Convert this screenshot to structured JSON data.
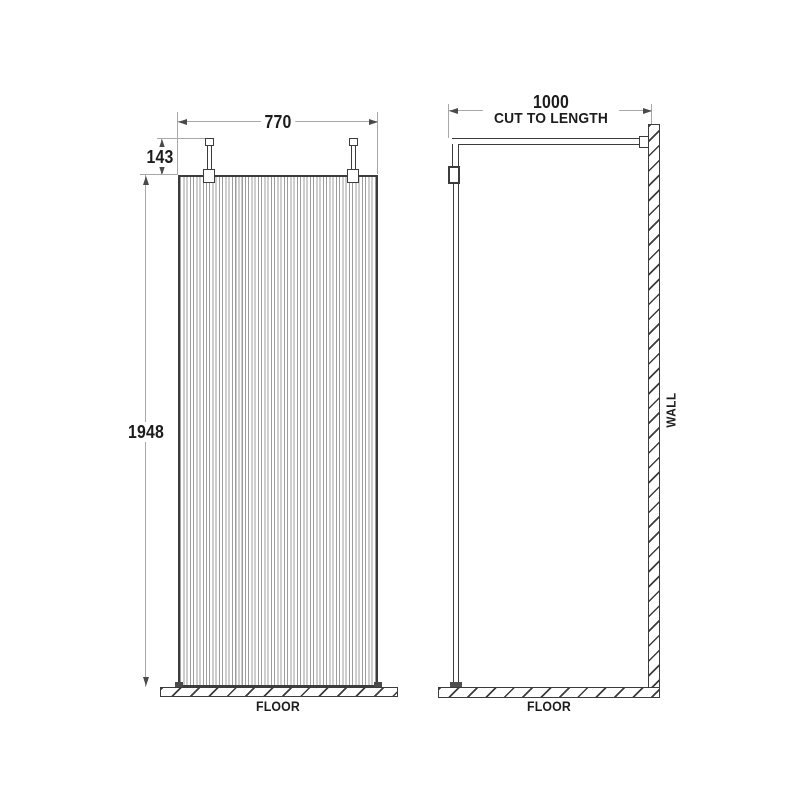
{
  "front_view": {
    "width_dim": "770",
    "bracket_height_dim": "143",
    "panel_height_dim": "1948",
    "floor_label": "FLOOR"
  },
  "side_view": {
    "arm_length_dim": "1000",
    "arm_note": "CUT TO LENGTH",
    "wall_label": "WALL",
    "floor_label": "FLOOR"
  },
  "colors": {
    "outline": "#3c3c3c",
    "flute_line": "#9c9c9c",
    "dimension_line": "#a8a8a8",
    "arrow": "#4a4a4a",
    "text": "#1c1c1c",
    "background": "#ffffff"
  }
}
